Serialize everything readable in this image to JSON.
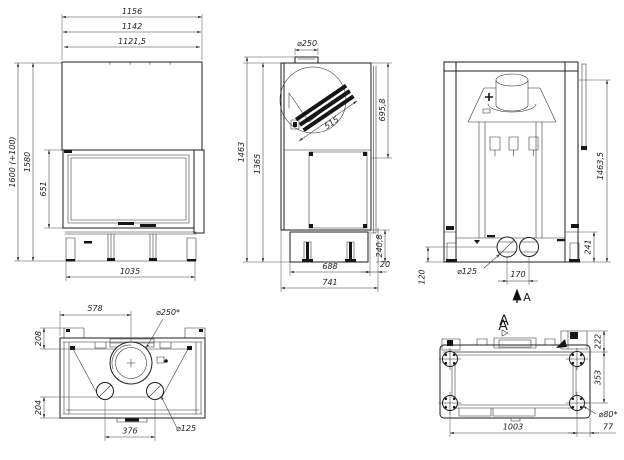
{
  "colors": {
    "line": "#1c1c1c",
    "dim_text": "#222222",
    "background": "#ffffff"
  },
  "views": {
    "front": {
      "overall_width": "1156",
      "body_width": "1142",
      "inner_width": "1121,5",
      "overall_height": "1600 (+100)",
      "body_height": "1580",
      "door_height": "651",
      "base_width": "1035"
    },
    "side": {
      "flue_diameter": "⌀250",
      "baffle_length": "515",
      "hood_height": "695,8",
      "overall_height": "1463",
      "body_height": "1365",
      "base_height": "240,8",
      "rear_offset": "20",
      "base_depth": "688",
      "overall_depth": "741"
    },
    "rear": {
      "overall_height": "1463,5",
      "base_height": "241",
      "outlet_diameter": "⌀125",
      "outlet_spacing": "170",
      "outlet_height": "120",
      "section_arrow_label": "A",
      "section_label": "A"
    },
    "plan": {
      "flue_center_offset": "578",
      "flue_diameter": "⌀250*",
      "rear_depth": "208",
      "front_depth": "204",
      "outlet_spacing": "376",
      "outlet_diameter": "⌀125"
    },
    "bottom": {
      "view_label": "A",
      "rear_offset": "222",
      "feet_depth": "353",
      "foot_diameter": "⌀80*",
      "feet_spacing": "1003",
      "foot_edge_offset": "77"
    }
  }
}
